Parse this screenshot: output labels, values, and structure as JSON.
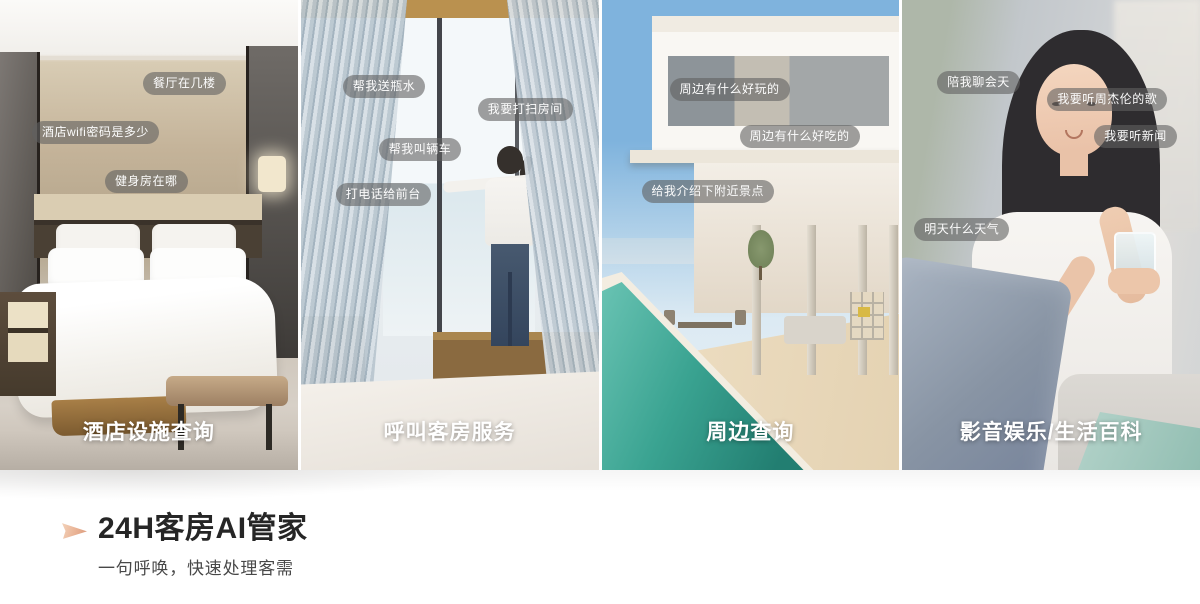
{
  "features": [
    {
      "photo": "hotel-bedroom",
      "caption": "酒店设施查询",
      "bubbles": [
        "餐厅在几楼",
        "酒店wifi密码是多少",
        "健身房在哪"
      ]
    },
    {
      "photo": "guest-opening-curtains",
      "caption": "呼叫客房服务",
      "bubbles": [
        "帮我送瓶水",
        "我要打扫房间",
        "帮我叫辆车",
        "打电话给前台"
      ]
    },
    {
      "photo": "seaside-villa-pool",
      "caption": "周边查询",
      "bubbles": [
        "周边有什么好玩的",
        "周边有什么好吃的",
        "给我介绍下附近景点"
      ]
    },
    {
      "photo": "woman-with-drink",
      "caption": "影音娱乐/生活百科",
      "bubbles": [
        "陪我聊会天",
        "我要听周杰伦的歌",
        "我要听新闻",
        "明天什么天气"
      ]
    }
  ],
  "footer": {
    "title": "24H客房AI管家",
    "subtitle": "一句呼唤，快速处理客需",
    "icon": "play-arrow-icon",
    "accent_color": "#e9b294"
  },
  "style": {
    "bubble_background": "rgba(96,96,96,0.6)",
    "bubble_text_color": "#ffffff",
    "caption_text_color": "#ffffff"
  }
}
